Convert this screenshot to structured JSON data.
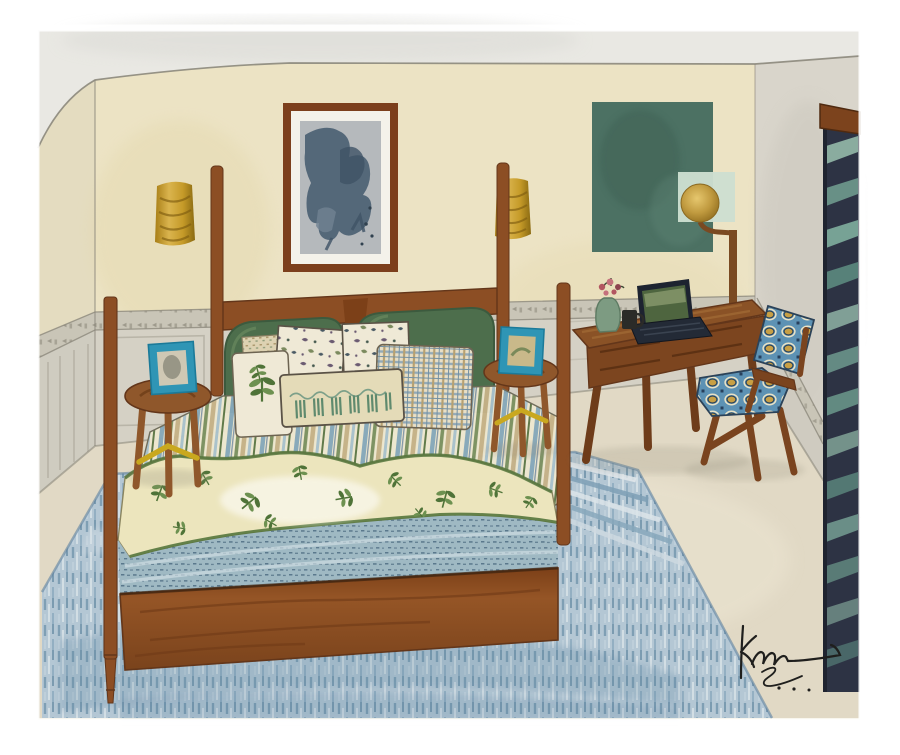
{
  "artwork": {
    "title": "Watercolor bedroom interior illustration",
    "description": "Watercolor painting of a cozy bedroom: a wooden four-poster bed with a green upholstered headboard, block-print and botanical pillows, striped sheet, leaf-print quilt and blue blanket; two round wooden stools with teal framed pictures; a wooden writing desk with an open laptop, green vase of flowers and a small mug; a wooden armchair with blue ikat cushions; a brass globe floor lamp; abstract framed art and a green color-field painting on cream walls; gold wall sconces; dark louvered shutters at right; large blue hatched rug; artist signature at lower right.",
    "signature_text": "km",
    "palette": {
      "paper": "#ffffff",
      "ceiling": "#e9e8e3",
      "wall": "#ece3c4",
      "wallLeft": "#e4dcc0",
      "wallRight": "#d9d5cb",
      "wainscot": "#d5d1c5",
      "wainscotLeft": "#cfccc0",
      "railBand": "#c9c5b7",
      "railMark": "#7e7b6c",
      "floor": "#e1d9c5",
      "rugBase": "#b4c7d4",
      "rugDark": "#6d90a8",
      "rugLight": "#d6e0e6",
      "wood": "#8c4e24",
      "woodDark": "#63361a",
      "green": "#4d6e4c",
      "greenDark": "#3c5a3e",
      "sheet": "#eee8d0",
      "stripeBlue": "#87a9ba",
      "stripeGreen": "#7b9160",
      "stripeTan": "#c6b288",
      "pillowCream": "#efe9d6",
      "quilt": "#ece5bd",
      "leaf": "#6d9150",
      "leafDark": "#4f7338",
      "quiltBorder": "#55763c",
      "blanket": "#9fb9c3",
      "blanketDot": "#4e6c82",
      "stoolWood": "#8f572b",
      "stretcher": "#c9a81f",
      "frameTeal": "#2f95b5",
      "frameInner": "#cfc8b4",
      "artFrame": "#7c3f1c",
      "artMat": "#f4f2ea",
      "artPaper": "#b5b9bc",
      "artBlob": "#4c6173",
      "greenArt": "#4c7163",
      "mint": "#cddfd0",
      "lampGold": "#c09a3f",
      "lampPole": "#7a4a22",
      "sconce": "#c59a28",
      "sconceDark": "#7e5c10",
      "shutter": "#2d3344",
      "shutterSlat": "#6f9a8e",
      "valance": "#7c431d",
      "desk": "#8a5226",
      "laptop": "#1d2330",
      "screen": "#4e653f",
      "vase": "#7d9b82",
      "flower": "#b25660",
      "chairWood": "#7a441f",
      "ikatBlue": "#5d92b4",
      "ikatGold": "#c8a045",
      "ikatCream": "#e9e2c6",
      "ink": "#1f1f1d",
      "pencil": "#8c887c"
    }
  }
}
